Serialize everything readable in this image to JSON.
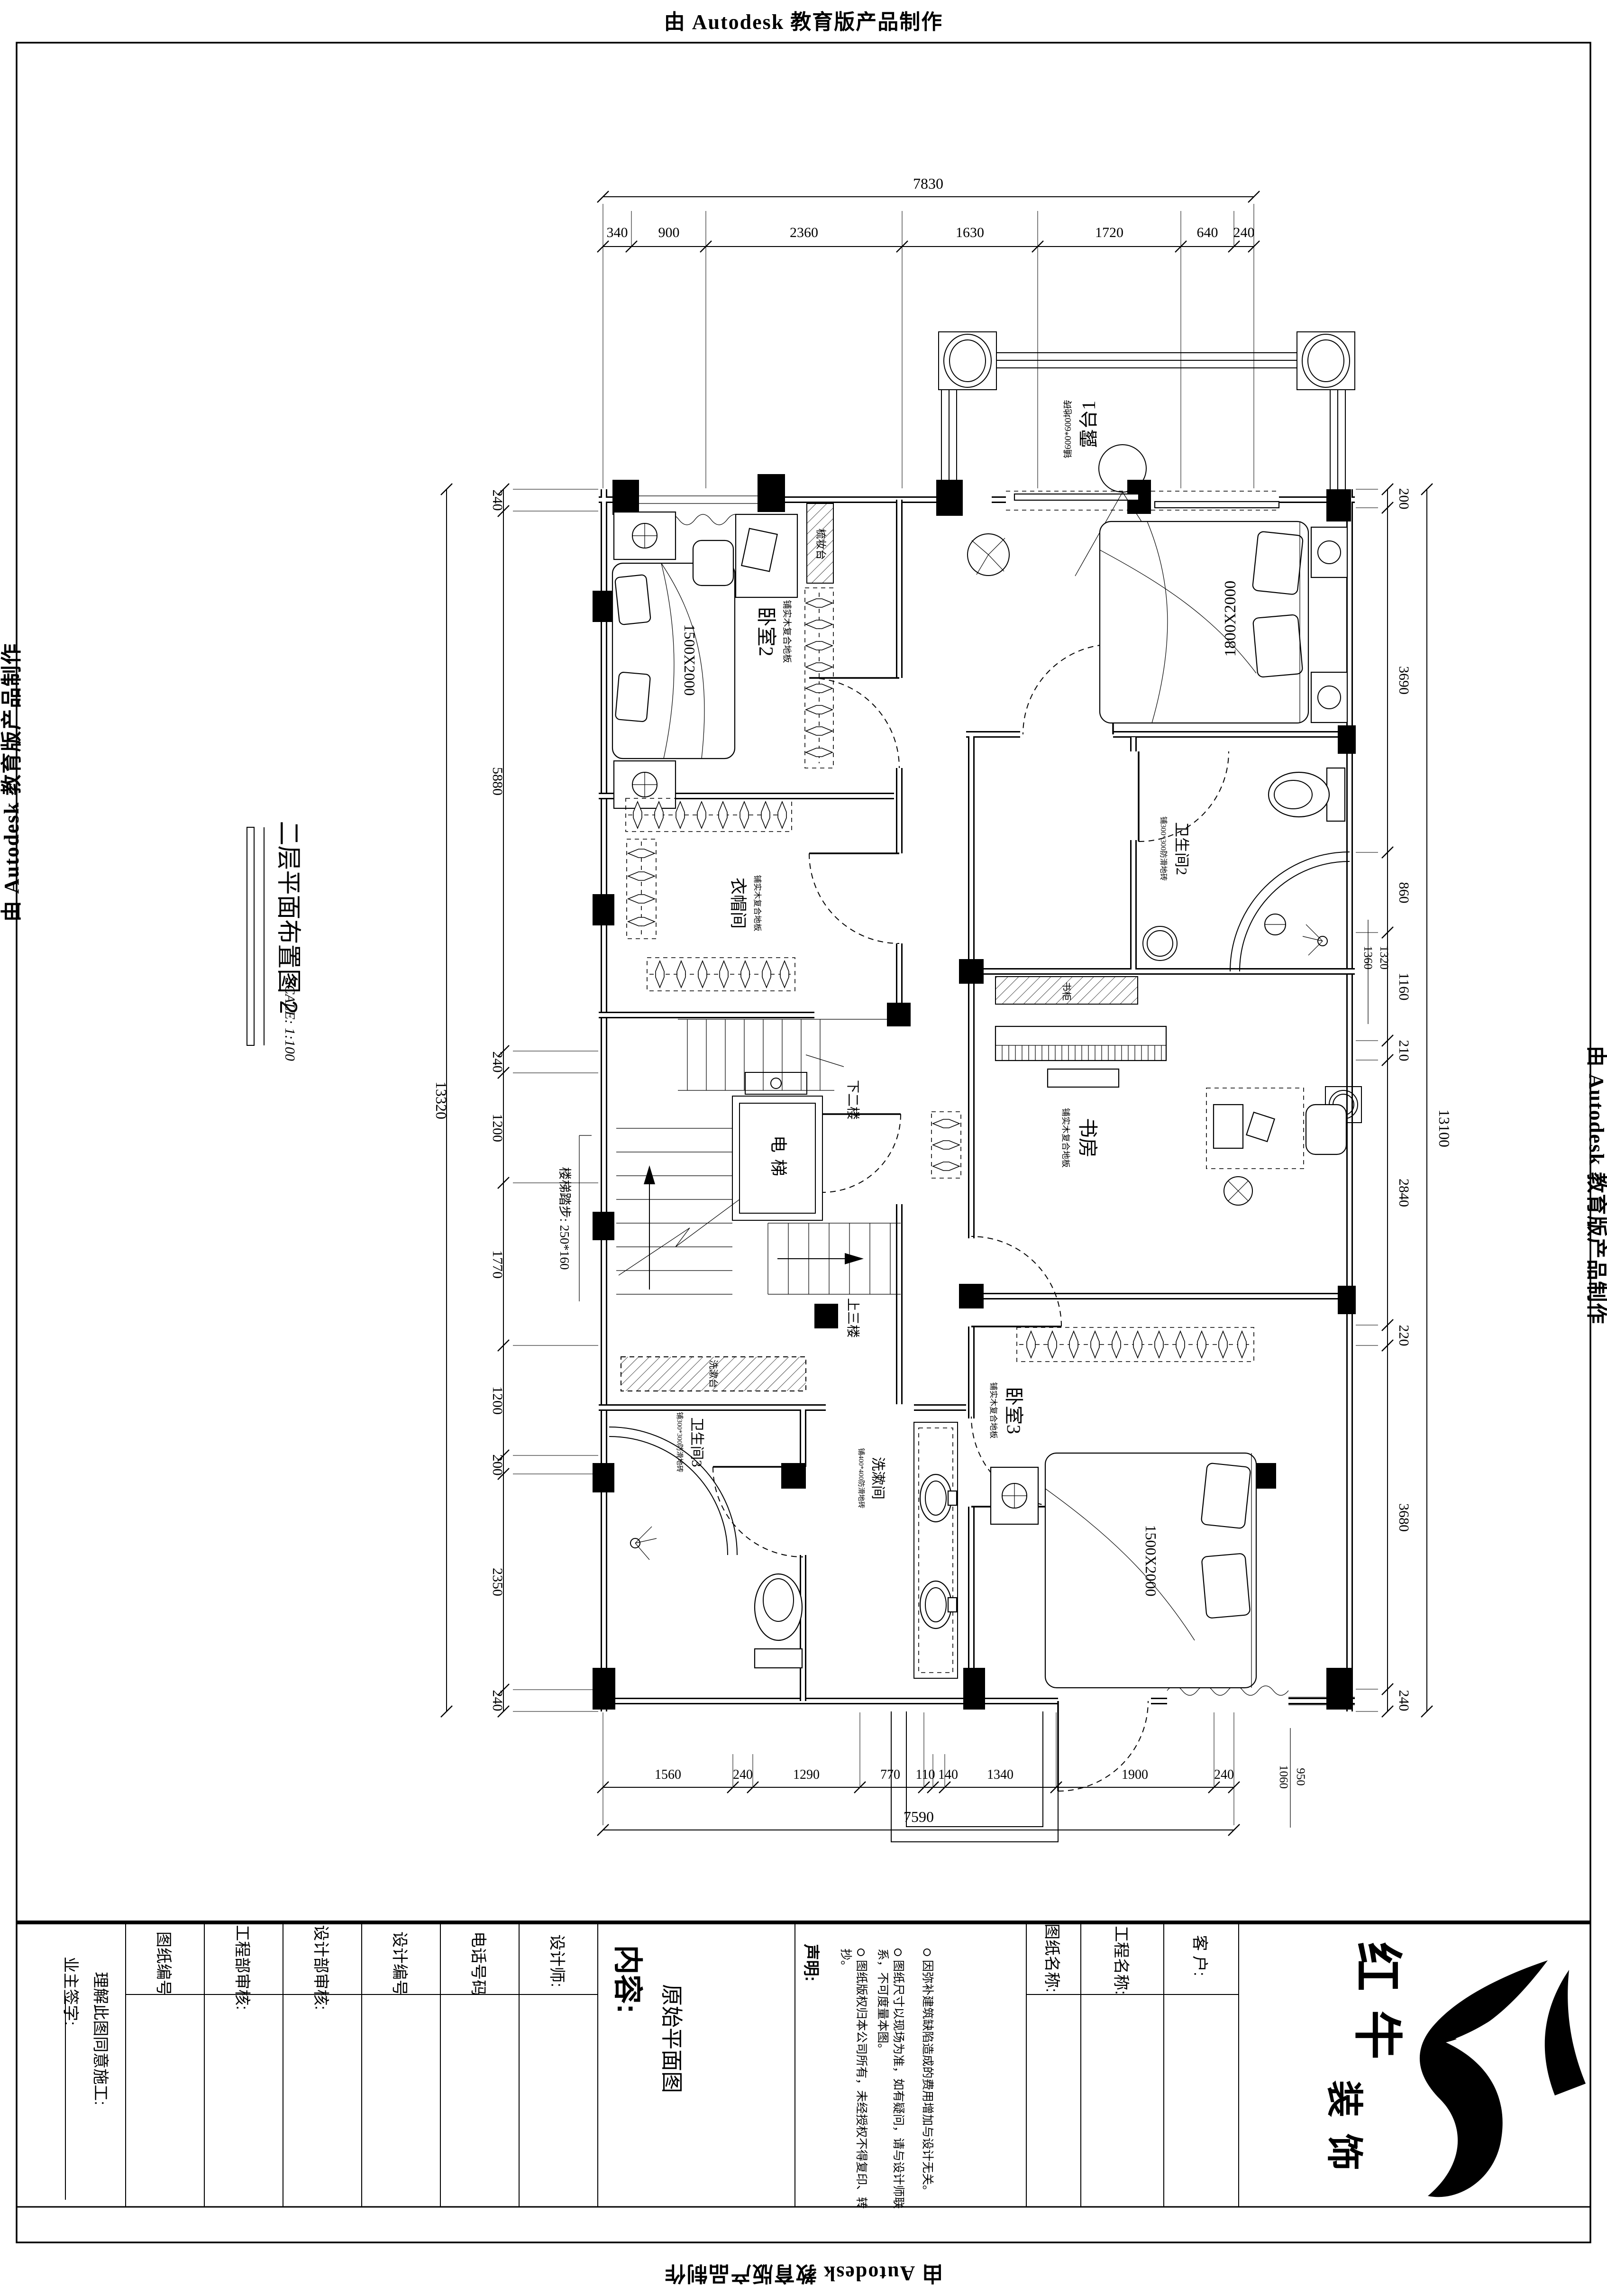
{
  "banner": {
    "text": "由 Autodesk 教育版产品制作"
  },
  "sheet_title": {
    "name": "二层平面布置图 2",
    "scale": "SCALE: 1:100"
  },
  "plan": {
    "rooms": {
      "terrace": {
        "name": "露台1",
        "spec": "铺600*600地砖"
      },
      "bedroom2": {
        "name": "卧室2",
        "spec": "铺实木复合地板",
        "bed": "1500X2000"
      },
      "bedroom1": {
        "bed": "1800X2000"
      },
      "cloakroom": {
        "name": "衣帽间",
        "spec": "铺实木复合地板"
      },
      "bath2": {
        "name": "卫生间2",
        "spec": "铺300*300防滑地砖"
      },
      "study": {
        "name": "书房",
        "spec": "铺实木复合地板"
      },
      "bedroom3": {
        "name": "卧室3",
        "spec": "铺实木复合地板",
        "bed": "1500X2000"
      },
      "bath3": {
        "name": "卫生间3",
        "spec": "铺300*300防滑地砖"
      },
      "washroom": {
        "name": "洗漱间",
        "spec": "铺400*400防滑地砖"
      },
      "elevator": {
        "name": "电梯"
      },
      "dresser": "梳妆台",
      "bookcase": "书柜",
      "vanity": "洗漱台",
      "stair_note": "楼梯踏步: 250*160",
      "stair_down": "下二楼",
      "stair_up": "上三楼"
    },
    "dims": {
      "top": {
        "total": "7830",
        "segs": [
          "340",
          "900",
          "2360",
          "1630",
          "1720",
          "640",
          "240"
        ]
      },
      "bottom": {
        "total": "7590",
        "segs": [
          "1560",
          "240",
          "1290",
          "770",
          "110",
          "140",
          "1340",
          "1900",
          "240"
        ]
      },
      "left": {
        "total": "13320",
        "segs": [
          "240",
          "5880",
          "240",
          "1200",
          "1770",
          "1200",
          "200",
          "2350",
          "240"
        ]
      },
      "right": {
        "total": "13100",
        "segs": [
          "200",
          "3690",
          "860",
          "1160",
          "210",
          "2840",
          "220",
          "3680",
          "240"
        ]
      },
      "aux_right": [
        "1360",
        "1320"
      ],
      "aux_bottom": [
        "1060",
        "950"
      ]
    }
  },
  "titleblock": {
    "owner_sign": "业主签字:",
    "agree": "理解此图同意施工:",
    "fields": [
      "图纸编号",
      "工程部审核:",
      "设计部审核:",
      "设计编号",
      "电话号码",
      "设计师:"
    ],
    "content_label": "内容:",
    "content_value": "原始平面图",
    "declaration_title": "声明:",
    "declarations": [
      "图纸版权归本公司所有，未经授权不得复印、转抄。",
      "图纸尺寸以现场为准，如有疑问，请与设计师联系，不可度量本图。",
      "因弥补建筑缺陷造成的费用增加与设计无关。"
    ],
    "drawing_name": "图纸名称:",
    "project_name": "工程名称:",
    "client": "客 户:",
    "brand_top": "红牛",
    "brand_bottom": "装饰"
  }
}
